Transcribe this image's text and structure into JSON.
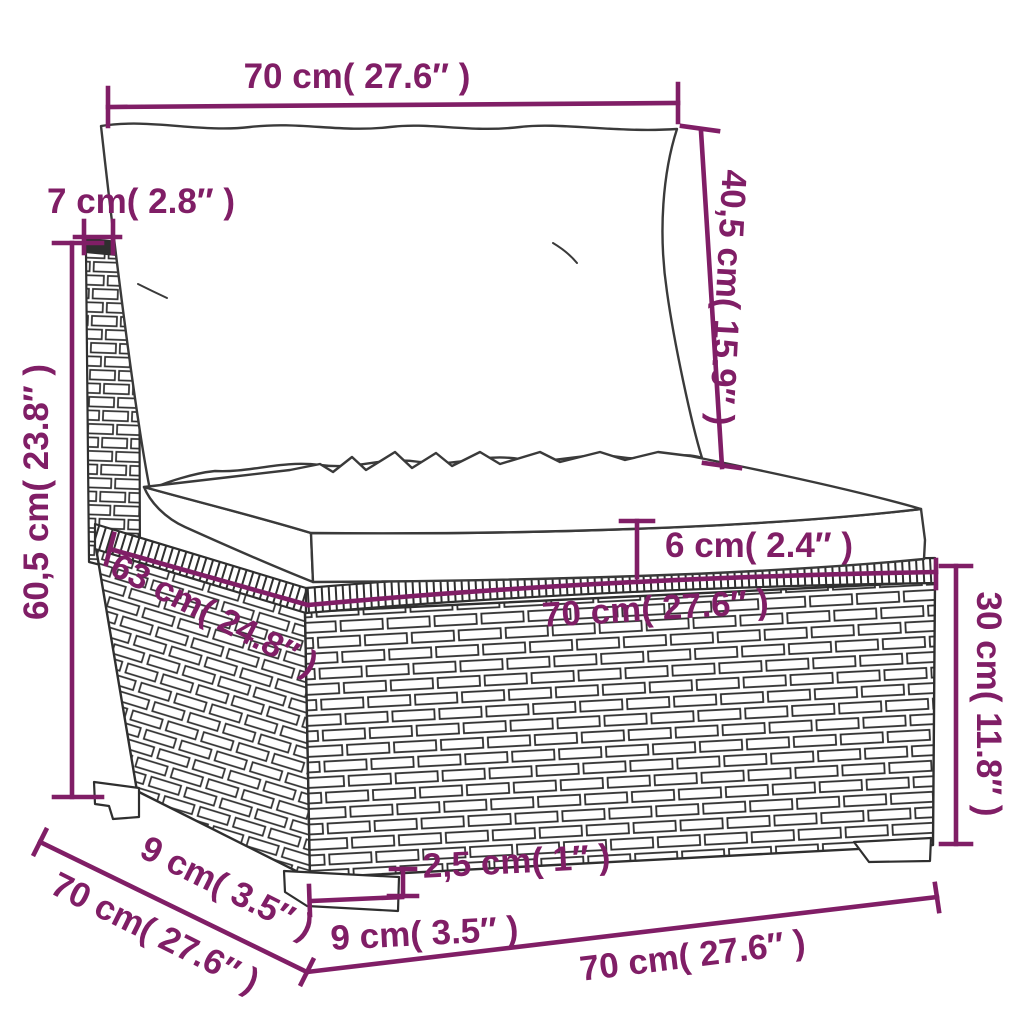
{
  "figure": {
    "title": "Product dimension diagram - poly rattan sofa middle section with cushions",
    "accent_color": "#801e66",
    "line_color": "#2f2f2f",
    "background": "#ffffff",
    "dimensions": {
      "top_width": "70 cm( 27.6″  )",
      "back_thickness": "7 cm( 2.8″  )",
      "total_height": "60,5 cm( 23.8″  )",
      "back_cushion_height": "40,5 cm( 15.9″  )",
      "seat_cushion_thickness": "6 cm( 2.4″  )",
      "seat_width": "70 cm( 27.6″  )",
      "seat_depth": "63 cm( 24.8″  )",
      "base_height": "30 cm( 11.8″  )",
      "leg_height": "2,5 cm( 1″ )",
      "leg_width": "9 cm( 3.5″  )",
      "leg_depth": "9 cm( 3.5″  )",
      "total_depth": "70 cm( 27.6″  )",
      "bottom_width": "70 cm( 27.6″  )"
    }
  }
}
